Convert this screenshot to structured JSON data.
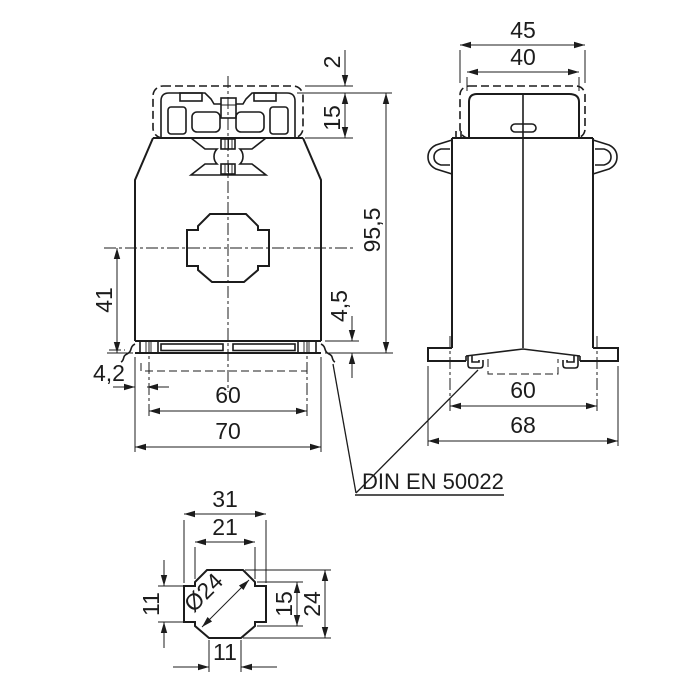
{
  "labels": {
    "din_rail": "DIN EN 50022"
  },
  "front_view": {
    "dims": {
      "cover_offset": "2",
      "terminal_height": "15",
      "overall_height": "95,5",
      "rail_step": "4,5",
      "center_to_base": "41",
      "clip_offset": "4,2",
      "rail_span": "60",
      "overall_width": "70"
    }
  },
  "side_view": {
    "dims": {
      "cover_width": "45",
      "top_width": "40",
      "fixing_span": "60",
      "base_width": "68"
    }
  },
  "window_detail": {
    "dims": {
      "outer_width": "31",
      "inner_width": "21",
      "bore": "Ø24",
      "side_height": "15",
      "outer_height": "24",
      "arm_height": "11",
      "arm_width": "11"
    }
  }
}
